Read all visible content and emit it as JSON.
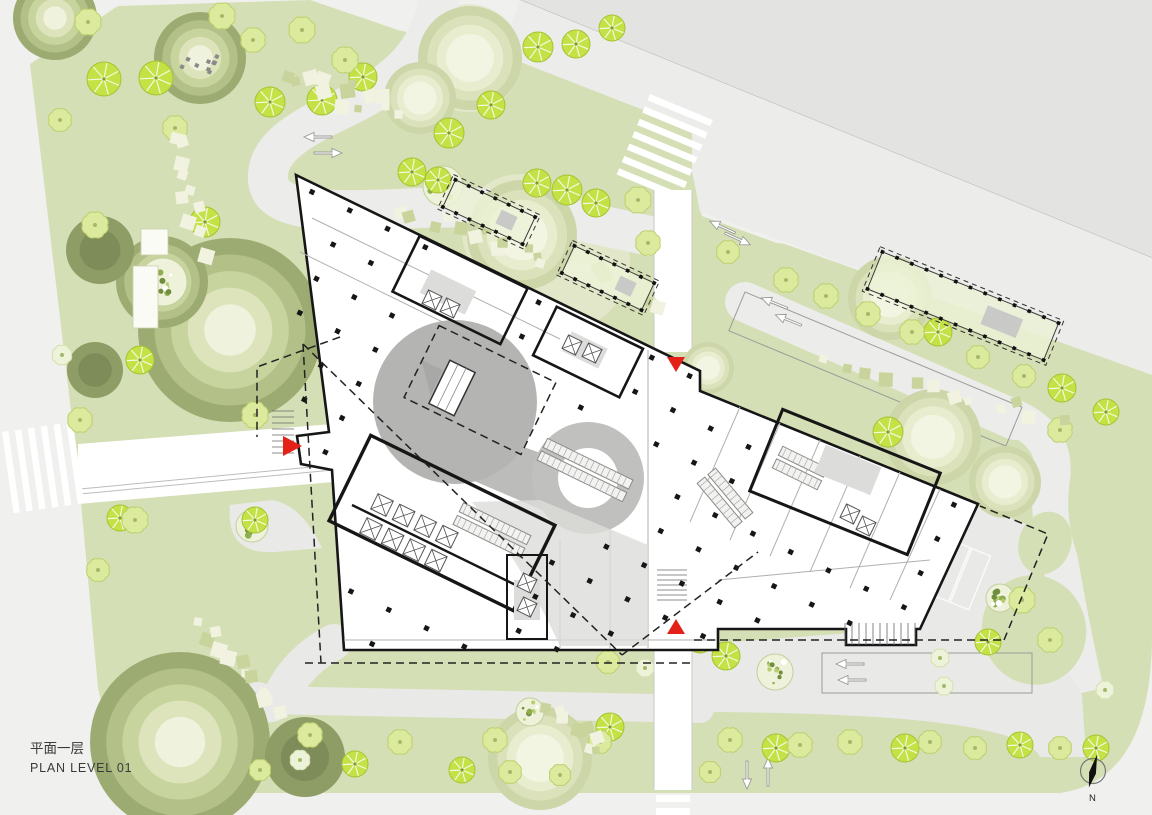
{
  "title_block": {
    "title_zh": "平面一层",
    "title_en": "PLAN LEVEL 01"
  },
  "compass": {
    "label": "N"
  },
  "colors": {
    "background": "#f0f0ee",
    "road_major_band": "#e3e3e1",
    "band_edge_line": "#c2c2c0",
    "road_light": "#ececea",
    "road_white": "#ffffff",
    "paving_gray": "#e9e9e7",
    "park_base": "#d5dfb5",
    "park_light": "#e4e9cc",
    "tree_soft": "#dcea9e",
    "tree_soft_edge": "#bcd06e",
    "tree_white": "#edf3d8",
    "tree_bright": "#c4e145",
    "tree_bright_edge": "#a4c433",
    "ring_dark": "#9cab72",
    "stone_cream": "#f1f2e0",
    "stone_olive": "#c9d49c",
    "building_wall": "#161616",
    "building_floor": "#ffffff",
    "atrium_gray": "#b4b4b2",
    "atrium_gray2": "#c0c0be",
    "plaza_gray": "#dcdcda",
    "dash_line": "#222222",
    "accent_red": "#e32119",
    "text_dark": "#3a3a3a"
  },
  "markers": {
    "entrance_arrows": [
      {
        "id": "west-entrance-arrow",
        "direction": "right"
      },
      {
        "id": "north-entrance-arrow",
        "direction": "down"
      },
      {
        "id": "south-entrance-arrow",
        "direction": "up"
      }
    ],
    "crosswalks": [
      "north-crosswalk",
      "west-crosswalk",
      "south-crosswalk"
    ],
    "lane_arrow_groups": 6
  }
}
